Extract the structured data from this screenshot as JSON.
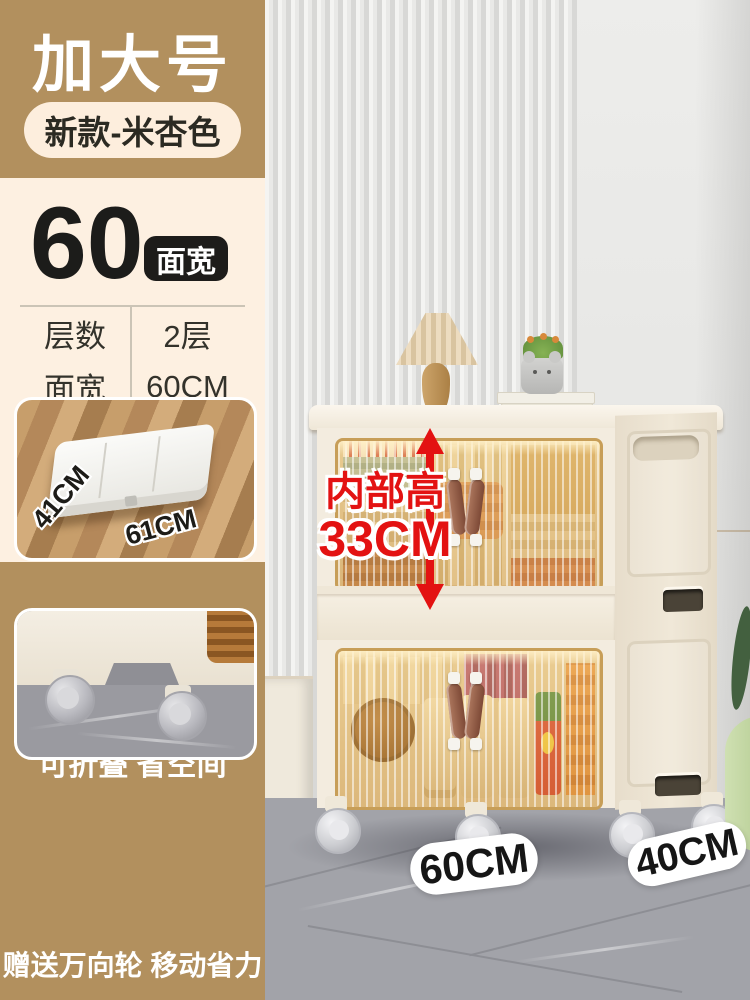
{
  "header": {
    "size_tag": "加大号",
    "variant_tag": "新款-米杏色"
  },
  "width_callout": {
    "number": "60",
    "badge": "面宽"
  },
  "spec_table": {
    "rows": [
      {
        "label": "层数",
        "value": "2层"
      },
      {
        "label": "面宽",
        "value": "60CM"
      },
      {
        "label": "侧深",
        "value": "40CM"
      },
      {
        "label": "高度",
        "value": "75CM"
      }
    ]
  },
  "fold_card": {
    "depth_label": "41CM",
    "width_label": "61CM",
    "caption": "可折叠 省空间"
  },
  "wheels_card": {
    "caption": "赠送万向轮 移动省力"
  },
  "annotation": {
    "line1": "内部高",
    "line2": "33CM"
  },
  "floor_labels": {
    "width": "60CM",
    "depth": "40CM"
  },
  "colors": {
    "brand_tan": "#b2905e",
    "panel_cream": "#fdf0e1",
    "pill_cream": "#fdeedd",
    "badge_black": "#1d1c1a",
    "accent_red": "#e31212",
    "cabinet_cream": "#f3ecdf",
    "door_amber": "#d9a75e"
  }
}
